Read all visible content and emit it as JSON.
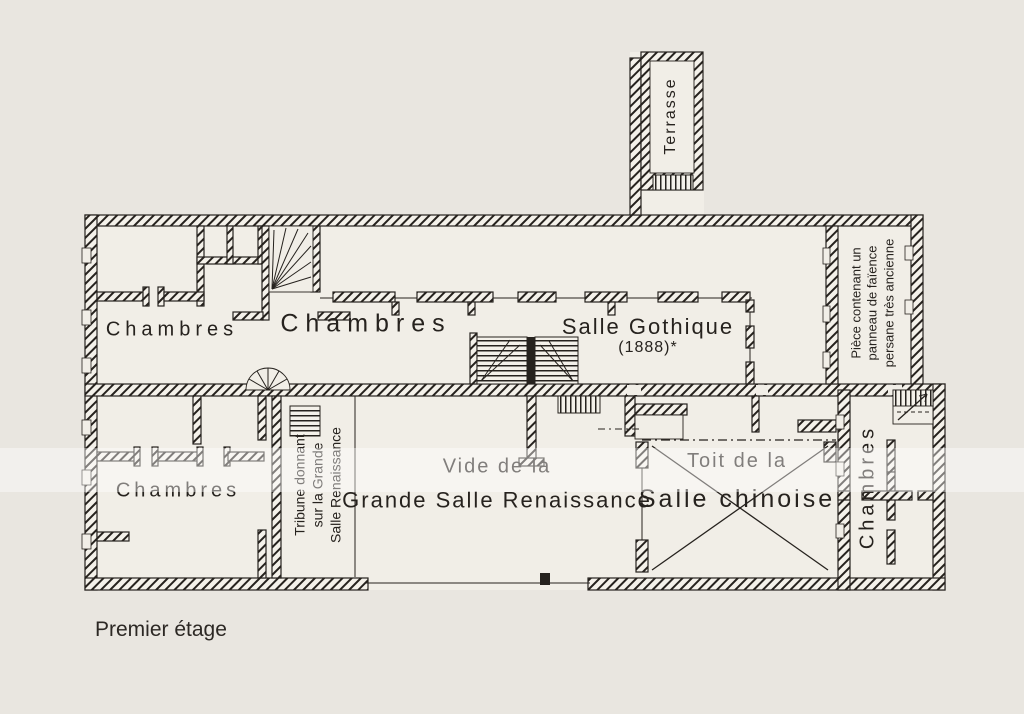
{
  "page": {
    "caption": "Premier étage",
    "colors": {
      "paper": "#e9e6e0",
      "ink": "#26221e"
    }
  },
  "plan": {
    "labels": {
      "terrasse": "Terrasse",
      "chambres_top_left": "Chambres",
      "chambres_top_mid": "Chambres",
      "salle_gothique_line1": "Salle Gothique",
      "salle_gothique_line2": "(1888)*",
      "piece_line1": "Pièce contenant un",
      "piece_line2": "panneau de faïence",
      "piece_line3": "persane très ancienne",
      "tribune_line1": "Tribune donnant",
      "tribune_line2": "sur la Grande",
      "tribune_line3": "Salle Renaissance",
      "vide_line1": "Vide de la",
      "vide_line2": "Grande Salle Renaissance",
      "toit_line1": "Toit de la",
      "toit_line2": "Salle chinoise",
      "chambres_right": "Chambres",
      "chambres_bottom_left": "Chambres"
    }
  }
}
